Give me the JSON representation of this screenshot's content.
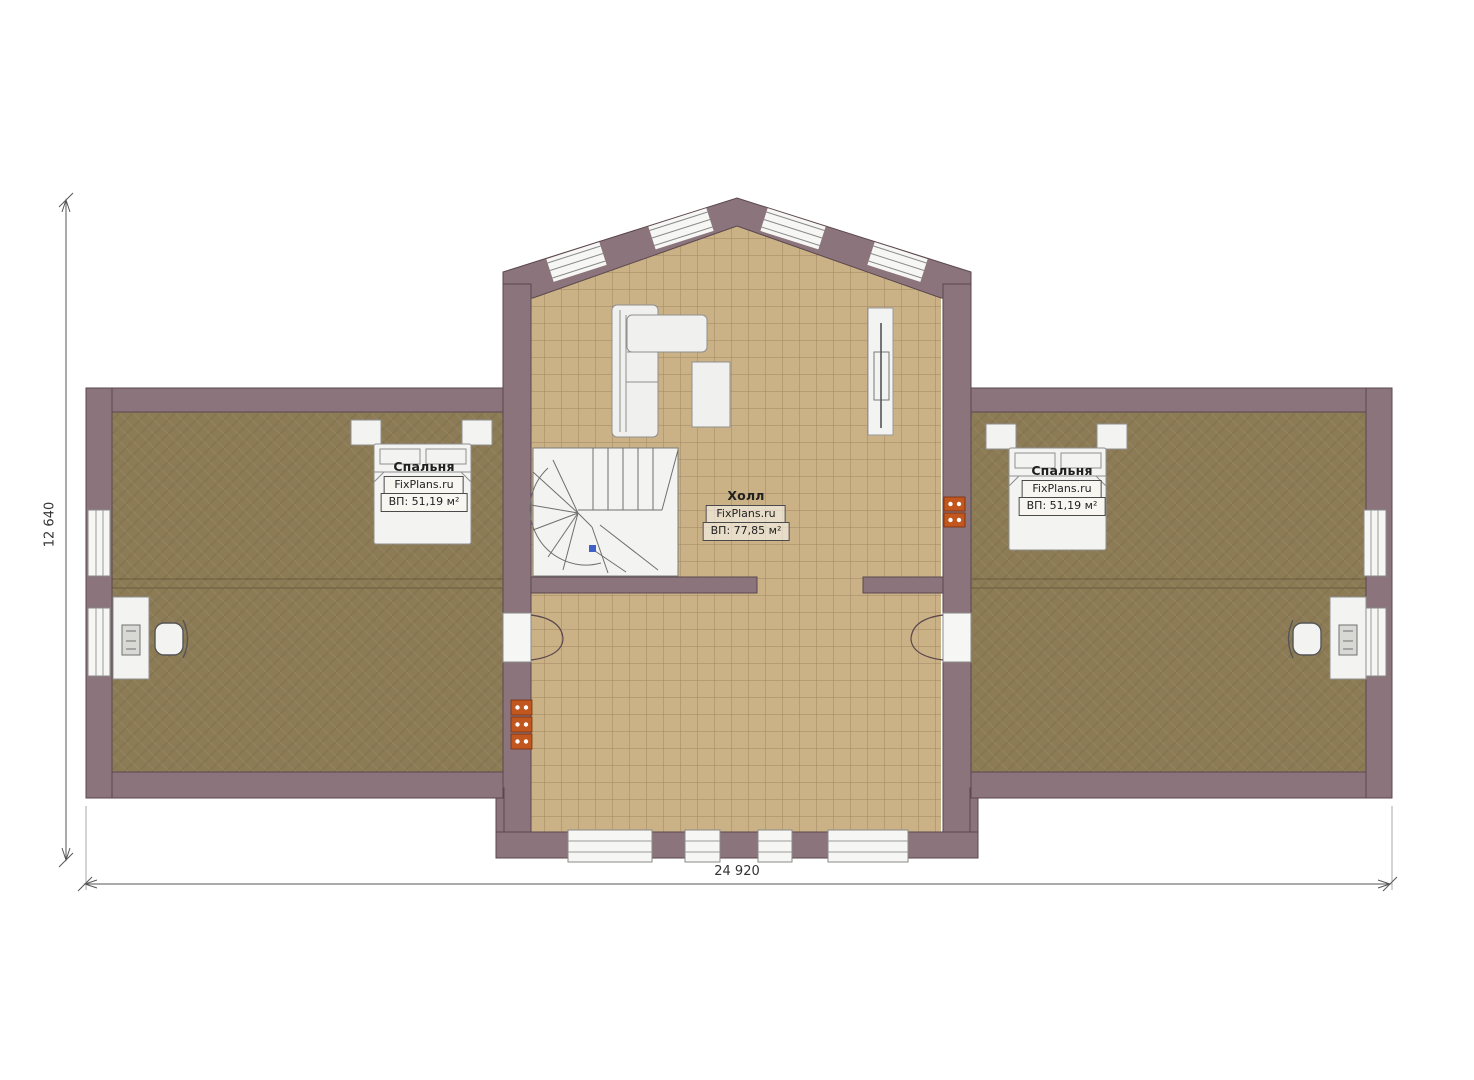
{
  "plan": {
    "rooms": {
      "bedroom_left": {
        "name": "Спальня",
        "brand": "FixPlans.ru",
        "area": "ВП: 51,19 м²"
      },
      "hall": {
        "name": "Холл",
        "brand": "FixPlans.ru",
        "area": "ВП: 77,85 м²"
      },
      "bedroom_right": {
        "name": "Спальня",
        "brand": "FixPlans.ru",
        "area": "ВП: 51,19 м²"
      }
    },
    "dimensions": {
      "overall_width": "24 920",
      "overall_height": "12 640"
    },
    "colors": {
      "wall": "#8b747b",
      "wall_outline": "#5a474d",
      "tile_floor": "#cbb286",
      "carpet_floor": "#8c7b55",
      "furniture_white": "#f3f3f1",
      "socket_accent": "#c2561f",
      "stair_marker_blue": "#3f5fc9"
    }
  }
}
